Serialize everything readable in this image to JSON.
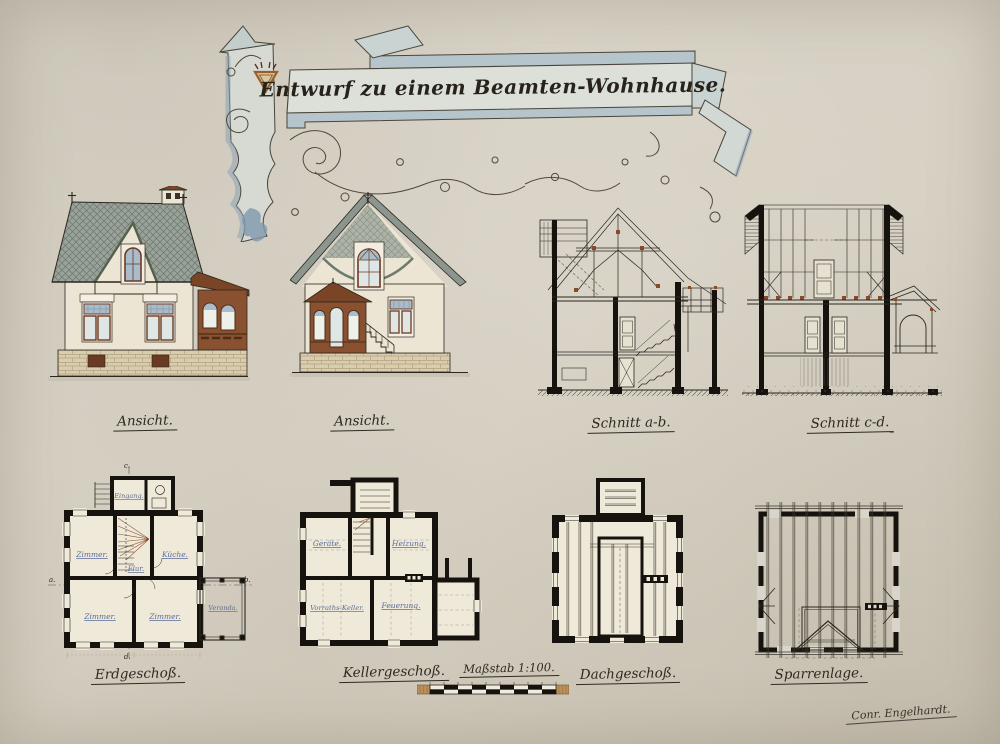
{
  "title": {
    "text": "Entwurf zu einem Beamten-Wohnhause."
  },
  "captions": {
    "elevation1": "Ansicht.",
    "elevation2": "Ansicht.",
    "section_ab": "Schnitt a-b.",
    "section_cd": "Schnitt c-d.",
    "plan_ground": "Erdgeschoß.",
    "plan_basement": "Kellergeschoß.",
    "plan_attic": "Dachgeschoß.",
    "plan_rafters": "Sparrenlage.",
    "scale": "Maßstab 1:100."
  },
  "ground_floor_rooms": {
    "entrance": "Eingang.",
    "room_top_left": "Zimmer.",
    "kitchen": "Küche.",
    "hall": "Flur.",
    "room_bottom_left": "Zimmer.",
    "room_bottom_center": "Zimmer.",
    "veranda": "Veranda."
  },
  "basement_rooms": {
    "equipment": "Geräte.",
    "heating": "Heizung.",
    "storage_cellar": "Vorraths-Keller.",
    "fuel": "Feuerung."
  },
  "section_markers": {
    "a": "a.",
    "b": "b.",
    "c": "c.",
    "d": "d."
  },
  "signature": "Conr. Engelhardt.",
  "colors": {
    "paper": "#d8d2c5",
    "ink": "#2b2720",
    "roof_slate": "#97a097",
    "wall_cream": "#ece5d3",
    "wood_brown": "#7a4426",
    "glass_blue": "#a9bccb",
    "banner_blue": "#b3c3ca",
    "label_blue": "#5a6d99",
    "scale_wood": "#bd8e55"
  }
}
